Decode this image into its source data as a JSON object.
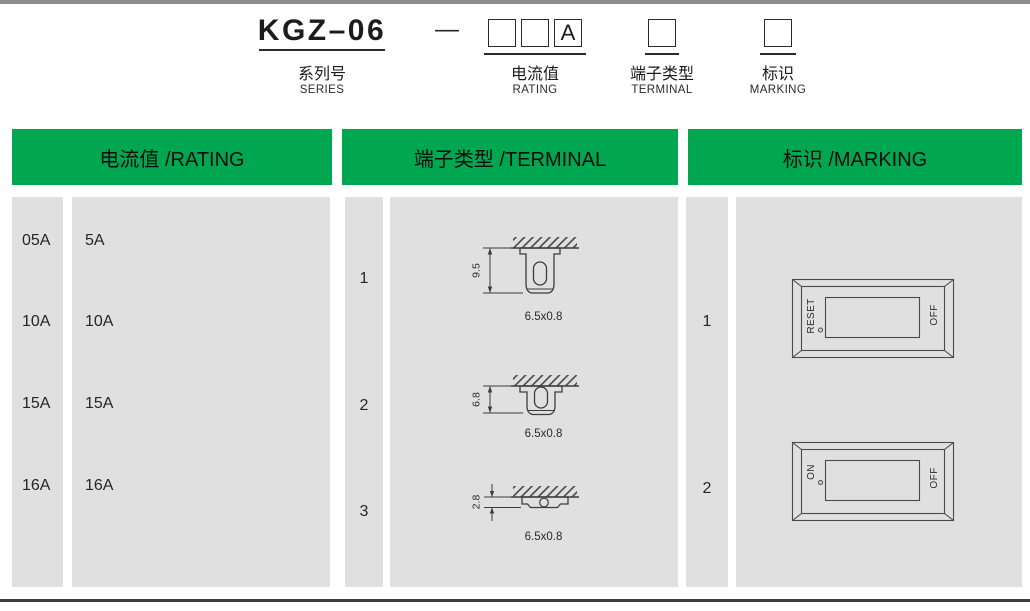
{
  "colors": {
    "header_green": "#00a650",
    "cell_gray": "#e0e0e0",
    "top_rule_gray": "#8d8d8d",
    "bottom_rule_gray": "#3f3f3f",
    "line_art": "#3c3c3c"
  },
  "model_code": {
    "series_code": "KGZ–06",
    "separator": "—",
    "rating_box_1": "",
    "rating_box_2": "",
    "rating_box_3": "A",
    "terminal_box": "",
    "marking_box": "",
    "series_label_cn": "系列号",
    "series_label_en": "SERIES",
    "rating_label_cn": "电流值",
    "rating_label_en": "RATING",
    "terminal_label_cn": "端子类型",
    "terminal_label_en": "TERMINAL",
    "marking_label_cn": "标识",
    "marking_label_en": "MARKING"
  },
  "rating": {
    "header": "电流值 /RATING",
    "rows": [
      {
        "code": "05A",
        "value": "5A"
      },
      {
        "code": "10A",
        "value": "10A"
      },
      {
        "code": "15A",
        "value": "15A"
      },
      {
        "code": "16A",
        "value": "16A"
      }
    ]
  },
  "terminal": {
    "header": "端子类型 /TERMINAL",
    "options": [
      {
        "code": "1",
        "height": "9.5",
        "size": "6.5x0.8"
      },
      {
        "code": "2",
        "height": "6.8",
        "size": "6.5x0.8"
      },
      {
        "code": "3",
        "height": "2.8",
        "size": "6.5x0.8"
      }
    ]
  },
  "marking": {
    "header": "标识 /MARKING",
    "options": [
      {
        "code": "1",
        "left": "RESET",
        "right": "OFF"
      },
      {
        "code": "2",
        "left": "ON",
        "right": "OFF"
      }
    ]
  }
}
